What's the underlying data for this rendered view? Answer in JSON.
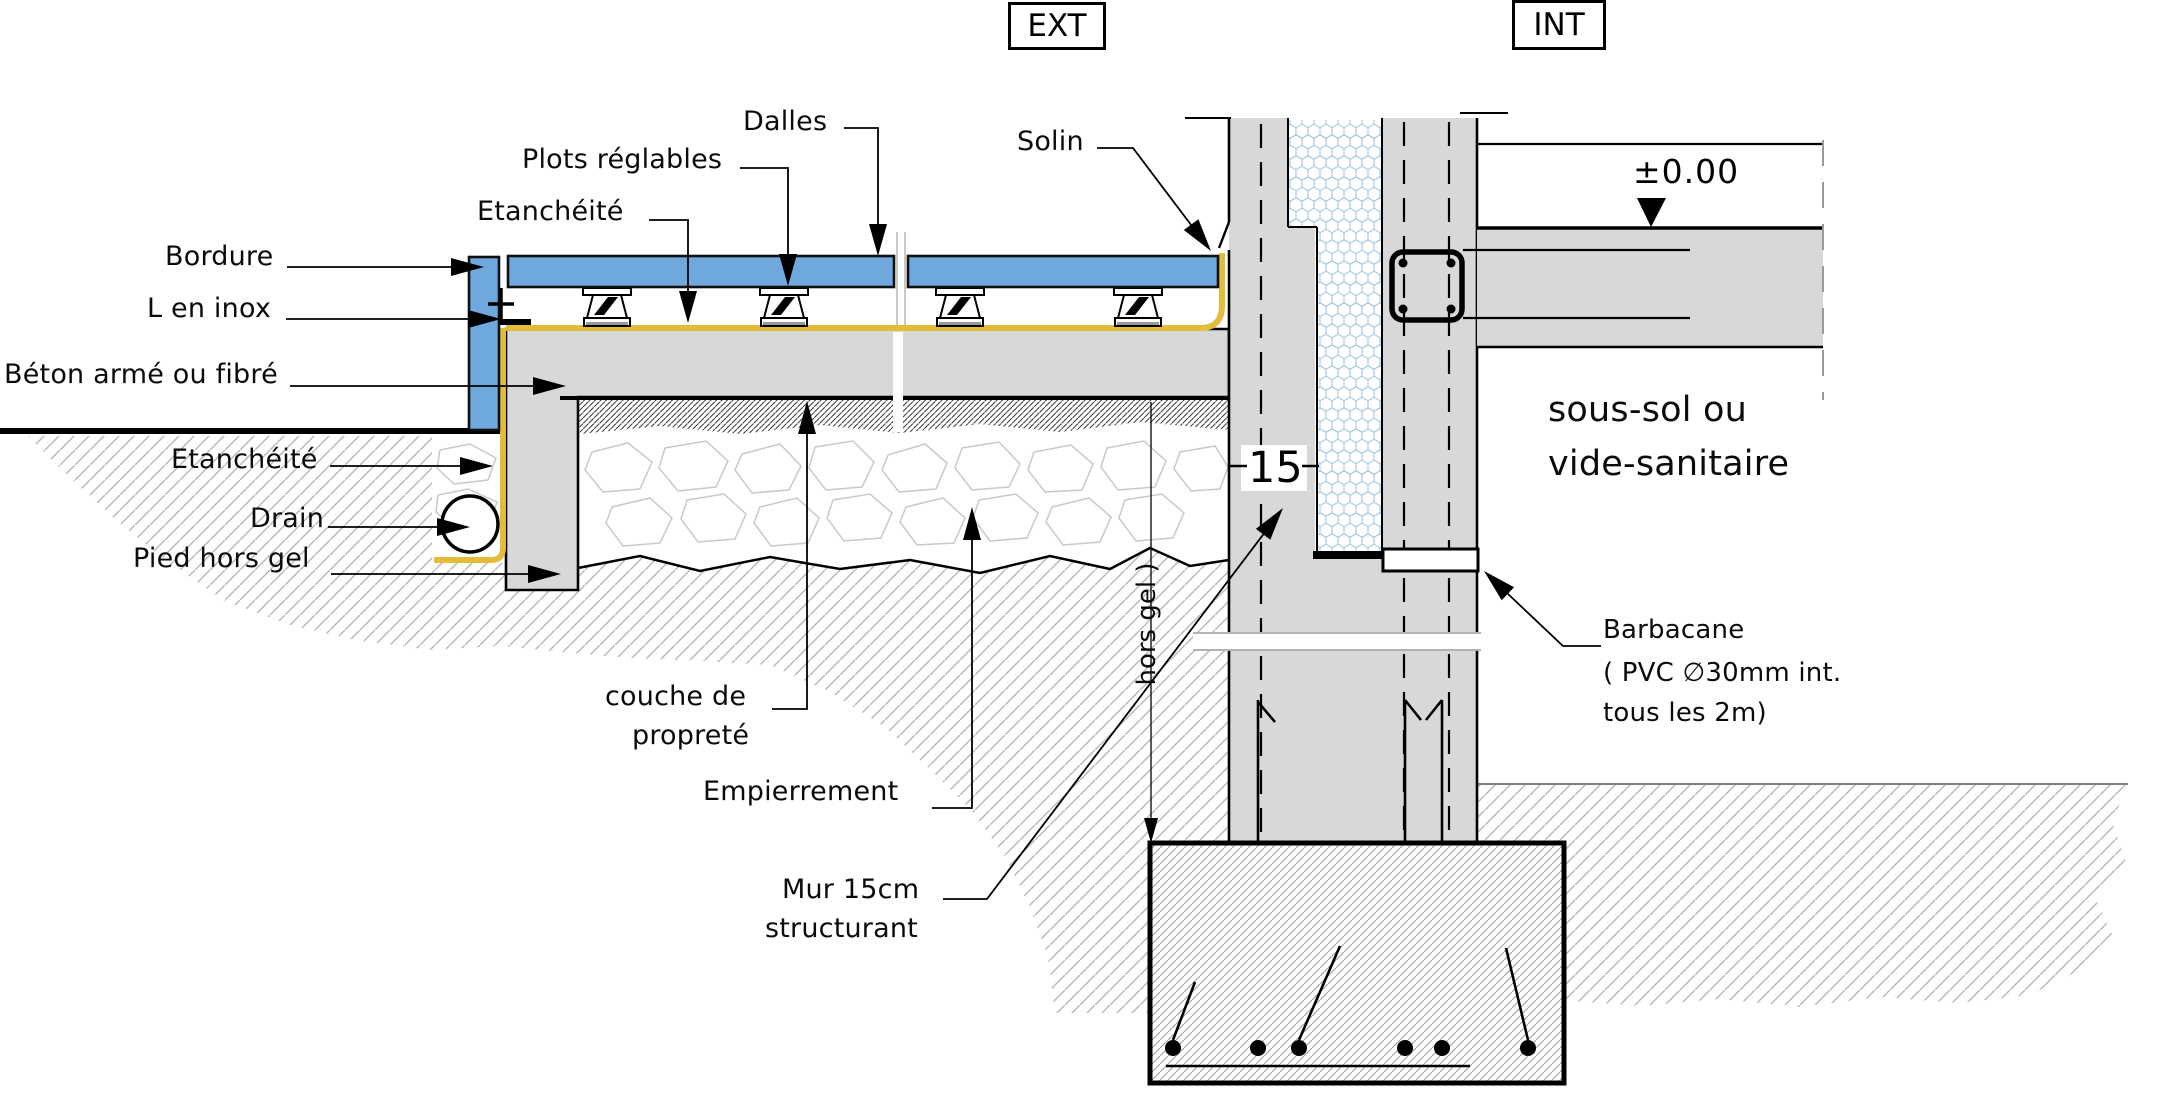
{
  "zones": {
    "exterior": "EXT",
    "interior": "INT"
  },
  "callouts": {
    "dalles": "Dalles",
    "plots": "Plots réglables",
    "etancheite_top": "Etanchéité",
    "solin": "Solin",
    "bordure": "Bordure",
    "l_en_inox": "L en inox",
    "beton": "Béton armé ou fibré",
    "etancheite_left": "Etanchéité",
    "drain": "Drain",
    "pied_hors_gel": "Pied hors gel",
    "couche_line1": "couche de",
    "couche_line2": "propreté",
    "empierrement": "Empierrement",
    "mur_line1": "Mur 15cm",
    "mur_line2": "structurant",
    "sous_sol_line1": "sous-sol ou",
    "sous_sol_line2": "vide-sanitaire",
    "barbacane_line1": "Barbacane",
    "barbacane_line2": "( PVC ∅30mm int.",
    "barbacane_line3": "tous les 2m)"
  },
  "annotations": {
    "level": "±0.00",
    "wall_width": "15",
    "frost_depth": "hors gel )"
  },
  "colors": {
    "paving_blue": "#6FA8DC",
    "membrane_yellow": "#E4BC3C",
    "concrete_gray": "#D8D8D8",
    "insulation_outline_blue": "#9CC2E0",
    "soil_hatch_gray": "#B9B9B9",
    "line_black": "#000000"
  }
}
